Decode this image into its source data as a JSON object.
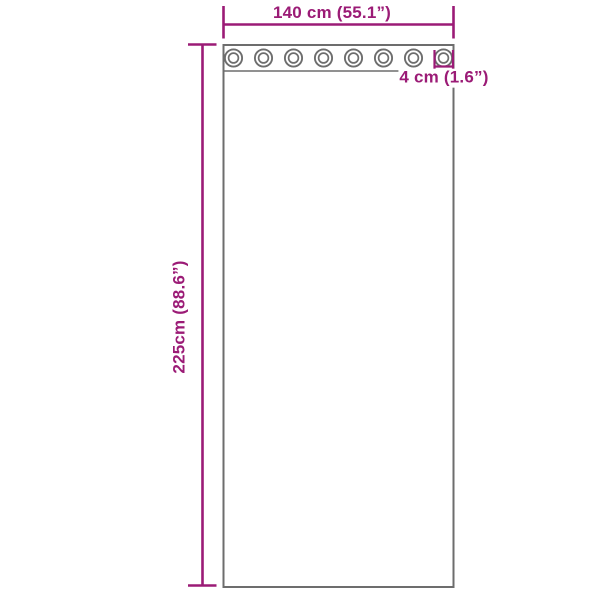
{
  "diagram": {
    "width_label": "140 cm (55.1”)",
    "height_label": "225cm (88.6”)",
    "grommet_size_label": "4 cm (1.6”)",
    "grommet_count": 8,
    "colors": {
      "dimension_accent": "#9b1b76",
      "outline_gray": "#6d6d6d",
      "background": "#ffffff"
    }
  }
}
